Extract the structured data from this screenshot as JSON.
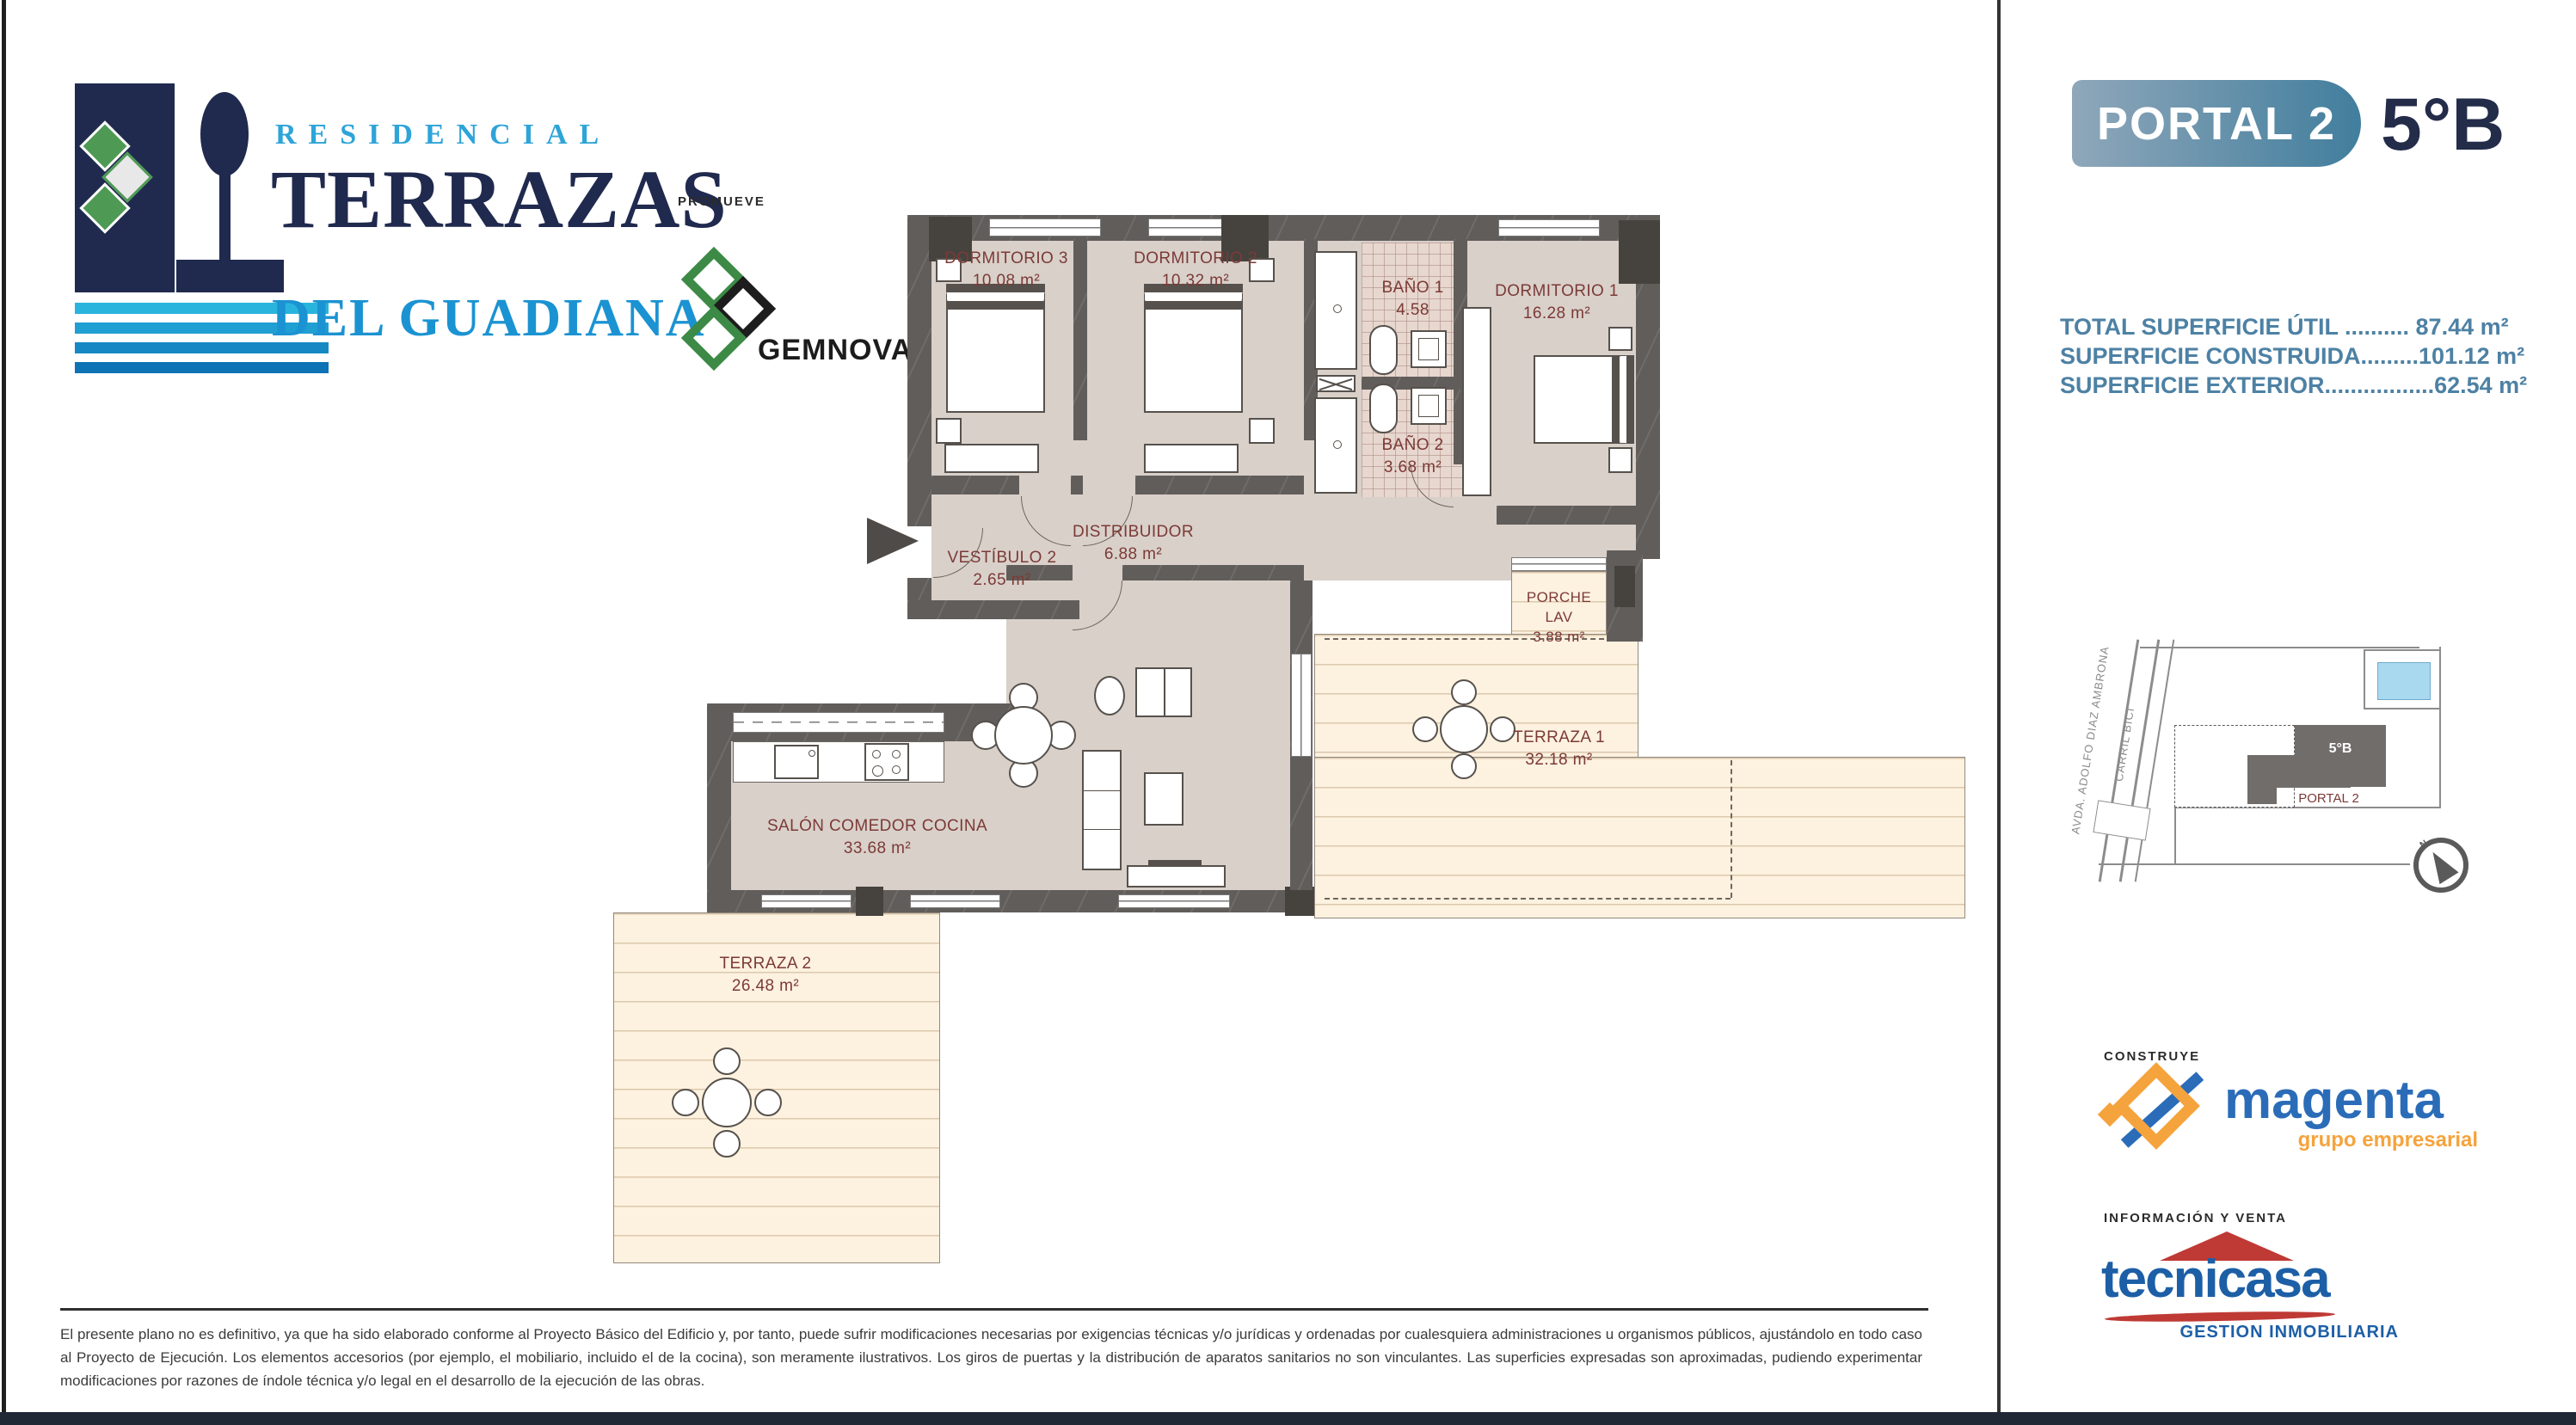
{
  "header": {
    "residencial": "RESIDENCIAL",
    "terrazas": "TERRAZAS",
    "del_guadiana": "DEL GUADIANA",
    "promueve_label": "PROMUEVE",
    "promoter_name": "GEMNOVA"
  },
  "unit": {
    "portal": "PORTAL 2",
    "flat": "5°B"
  },
  "surfaces": {
    "line1": "TOTAL SUPERFICIE ÚTIL .......... 87.44 m²",
    "line2": "SUPERFICIE CONSTRUIDA.........101.12 m²",
    "line3": "SUPERFICIE EXTERIOR.................62.54 m²"
  },
  "rooms": {
    "dorm3": {
      "name": "DORMITORIO 3",
      "area": "10.08 m²"
    },
    "dorm2": {
      "name": "DORMITORIO 2",
      "area": "10.32 m²"
    },
    "dorm1": {
      "name": "DORMITORIO 1",
      "area": "16.28 m²"
    },
    "bano1": {
      "name": "BAÑO 1",
      "area": "4.58"
    },
    "bano2": {
      "name": "BAÑO 2",
      "area": "3.68 m²"
    },
    "vestibulo": {
      "name": "VESTÍBULO 2",
      "area": "2.65 m²"
    },
    "distribuidor": {
      "name": "DISTRIBUIDOR",
      "area": "6.88 m²"
    },
    "porche": {
      "name": "PORCHE LAV",
      "area": "3.88 m²"
    },
    "terraza1": {
      "name": "TERRAZA 1",
      "area": "32.18 m²"
    },
    "salon": {
      "name": "SALÓN COMEDOR COCINA",
      "area": "33.68 m²"
    },
    "terraza2": {
      "name": "TERRAZA 2",
      "area": "26.48 m²"
    }
  },
  "sitemap": {
    "street1": "AVDA. ADOLFO DIAZ AMBRONA",
    "street2": "CARRIL BICI",
    "unit_label": "5°B",
    "portal_label": "PORTAL 2",
    "north": "N"
  },
  "footer": {
    "construye_label": "CONSTRUYE",
    "builder_name": "magenta",
    "builder_tagline": "grupo empresarial",
    "venta_label": "INFORMACIÓN Y VENTA",
    "agency_name": "tecnicasa",
    "agency_tagline": "GESTION INMOBILIARIA",
    "disclaimer": "El presente plano no es definitivo, ya que ha sido elaborado conforme al Proyecto Básico del Edificio y, por tanto, puede sufrir modificaciones necesarias por exigencias técnicas y/o jurídicas y ordenadas por cualesquiera administraciones u organismos públicos, ajustándolo en todo caso al Proyecto de Ejecución. Los elementos accesorios (por ejemplo, el mobiliario, incluido el de la cocina), son meramente ilustrativos. Los giros de puertas y la distribución de aparatos sanitarios no son vinculantes. Las superficies expresadas son aproximadas, pudiendo experimentar modificaciones por razones de índole técnica y/o legal en el desarrollo de la ejecución de las obras."
  },
  "colors": {
    "brand_navy": "#202a4e",
    "brand_cyan": "#2ea4d8",
    "brand_blue": "#1b93d2",
    "steel_text": "#4d81a4",
    "plan_label_red": "#7c3a36",
    "wall_gray": "#615d5a",
    "floor_taupe": "#d9d0ca",
    "deck_cream": "#fdf1df",
    "builder_blue": "#2b6cb8",
    "builder_orange": "#f5a33c",
    "agency_blue": "#1d5fa6",
    "agency_red": "#bf3a35"
  }
}
